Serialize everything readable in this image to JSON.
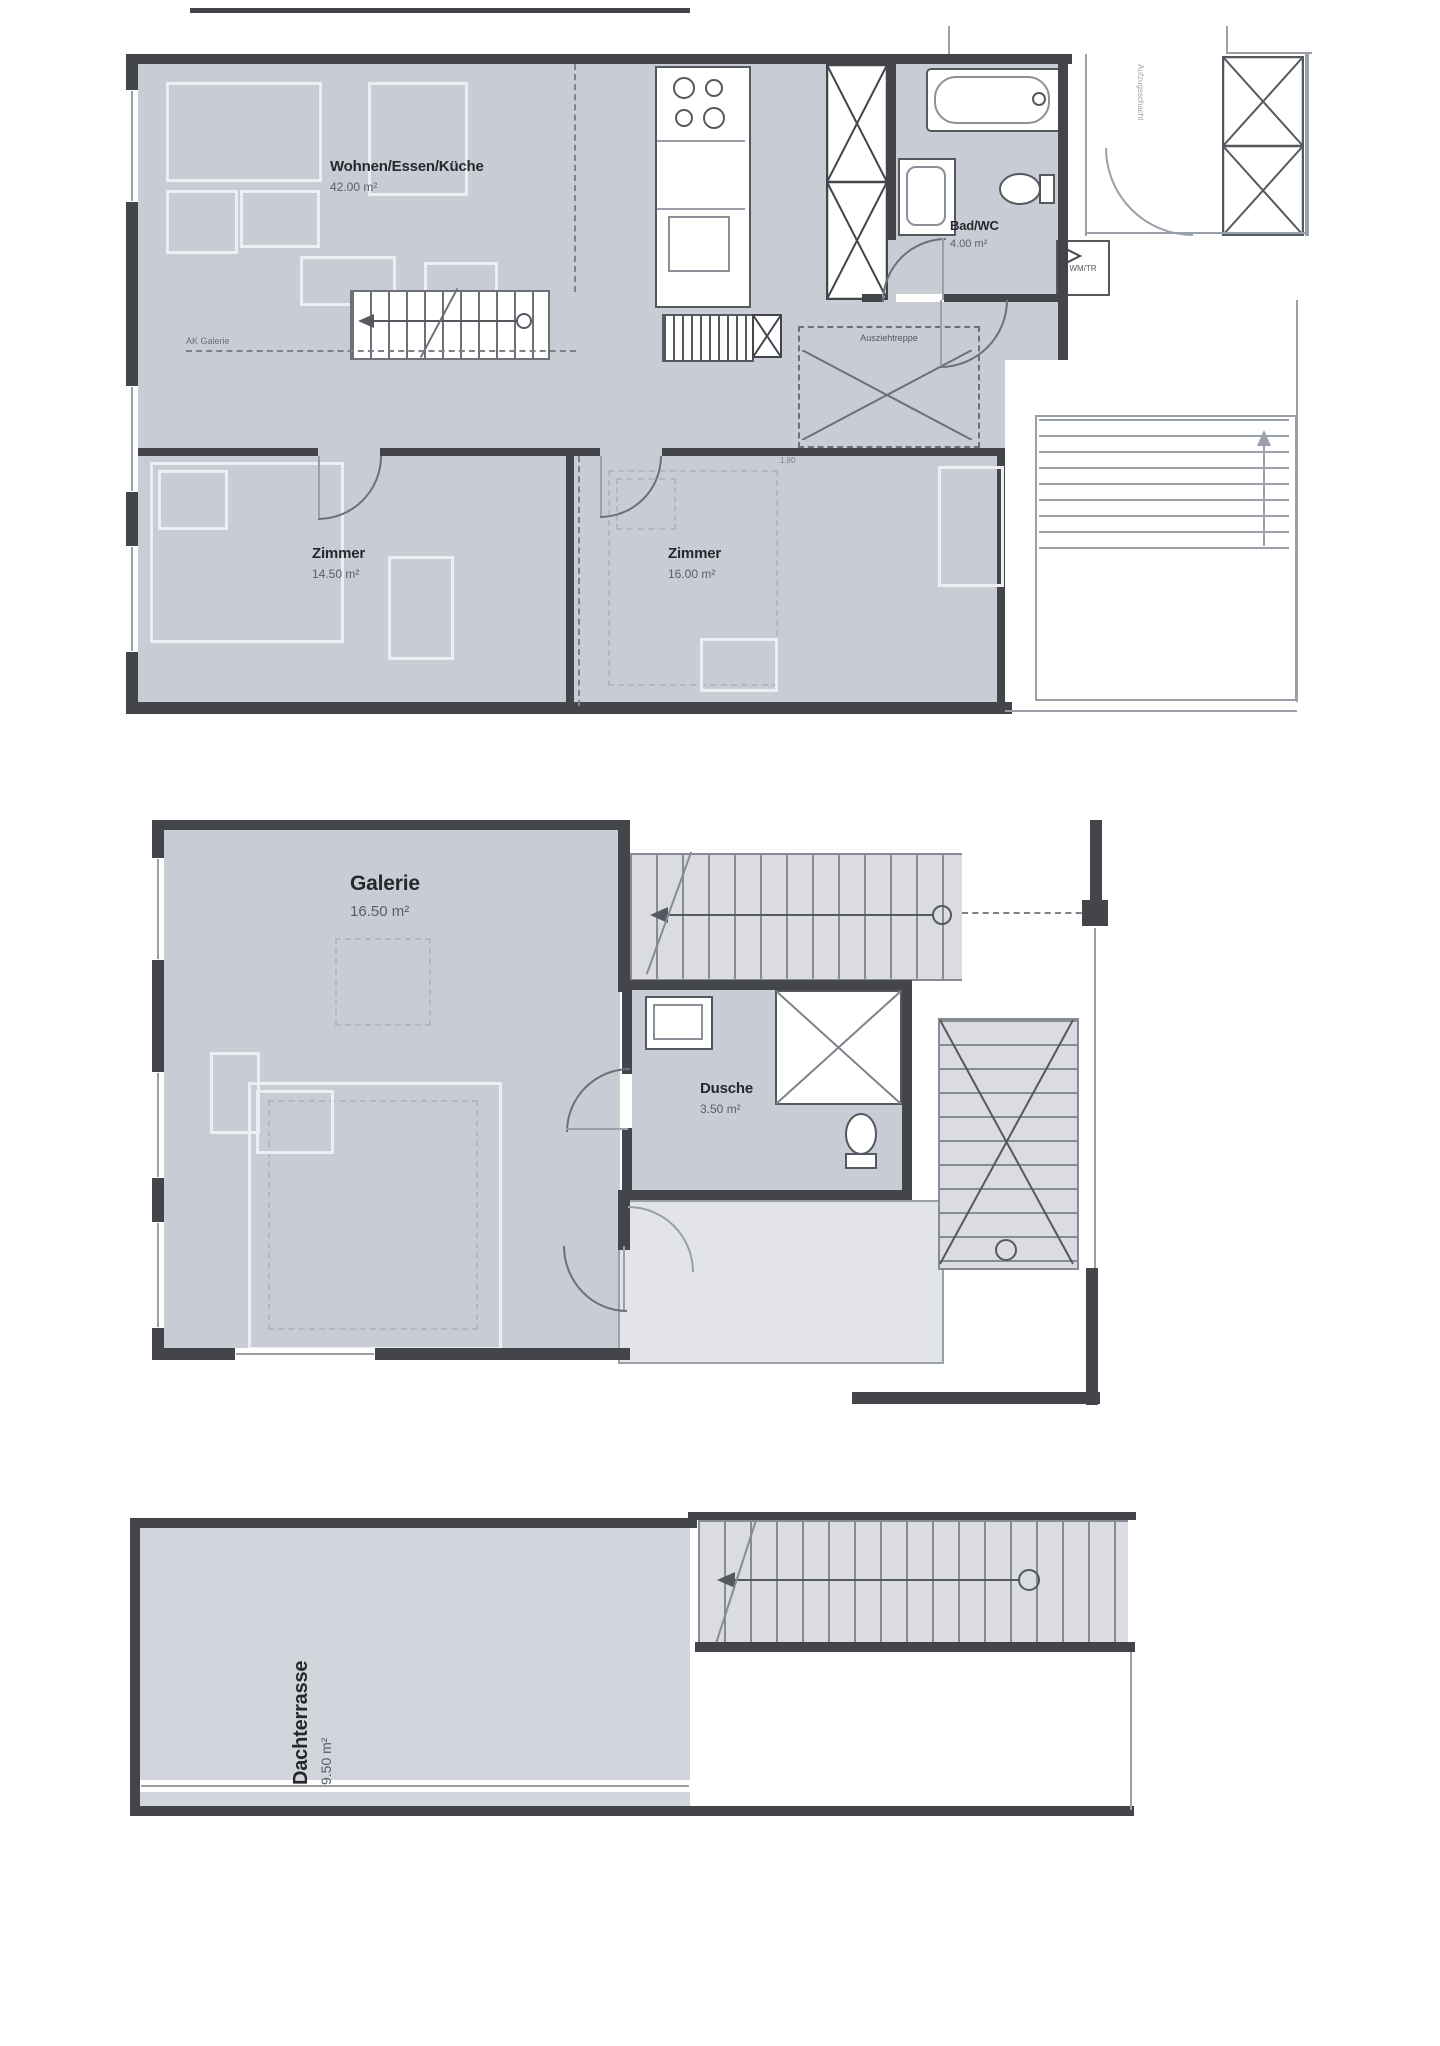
{
  "document": {
    "type": "floor-plan-drawing",
    "background": "#ffffff"
  },
  "colors": {
    "room_fill": "#c8ccd4",
    "light_fill": "#dadce1",
    "wall": "#43454a",
    "thin_line": "#9aa0a8",
    "accent_text": "#26282c"
  },
  "floor1": {
    "rooms": [
      {
        "name": "Wohnen/Essen/Küche",
        "area": "42.00 m²"
      },
      {
        "name": "Bad/WC",
        "area": "4.00 m²"
      },
      {
        "name": "Zimmer",
        "area": "14.50 m²"
      },
      {
        "name": "Zimmer",
        "area": "16.00 m²"
      }
    ],
    "labels": {
      "ak_galerie": "AK Galerie",
      "ausziehtreppe": "Ausziehtreppe",
      "wm_tr": "WM/TR",
      "aufzugsschacht": "Aufzugsschacht",
      "dim_1_80": "1.80"
    }
  },
  "floor2": {
    "rooms": [
      {
        "name": "Galerie",
        "area": "16.50 m²"
      },
      {
        "name": "Dusche",
        "area": "3.50 m²"
      }
    ]
  },
  "floor3": {
    "rooms": [
      {
        "name": "Dachterrasse",
        "area": "9.50 m²"
      }
    ]
  }
}
